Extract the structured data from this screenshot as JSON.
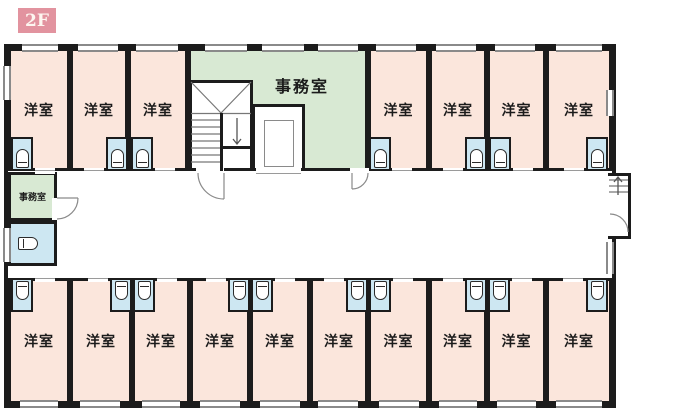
{
  "floor_badge": {
    "label": "2F"
  },
  "colors": {
    "badge_bg": "#e2939f",
    "room_fill": "#fbe6dc",
    "office_fill": "#d8e9d3",
    "bathroom_fill": "#cde7f2",
    "wall": "#1c1c1c",
    "window_line": "#8a8a8a"
  },
  "rooms": {
    "top_left": [
      {
        "label": "洋室"
      },
      {
        "label": "洋室"
      },
      {
        "label": "洋室"
      }
    ],
    "top_right": [
      {
        "label": "洋室"
      },
      {
        "label": "洋室"
      },
      {
        "label": "洋室"
      },
      {
        "label": "洋室"
      }
    ],
    "bottom": [
      {
        "label": "洋室"
      },
      {
        "label": "洋室"
      },
      {
        "label": "洋室"
      },
      {
        "label": "洋室"
      },
      {
        "label": "洋室"
      },
      {
        "label": "洋室"
      },
      {
        "label": "洋室"
      },
      {
        "label": "洋室"
      },
      {
        "label": "洋室"
      },
      {
        "label": "洋室"
      }
    ],
    "main_office": {
      "label": "事務室"
    },
    "small_office": {
      "label": "事務室"
    }
  },
  "icons": {
    "toilet": "toilet plan symbol (rounded rect with tank line)",
    "staircase": "stair flight with landing diagonals and down arrow",
    "external_stairs": "entry steps with up arrow",
    "elevator": "elevator shaft with cab rectangle",
    "door_swing": "quarter-circle door arc",
    "window": "double-line wall opening"
  }
}
